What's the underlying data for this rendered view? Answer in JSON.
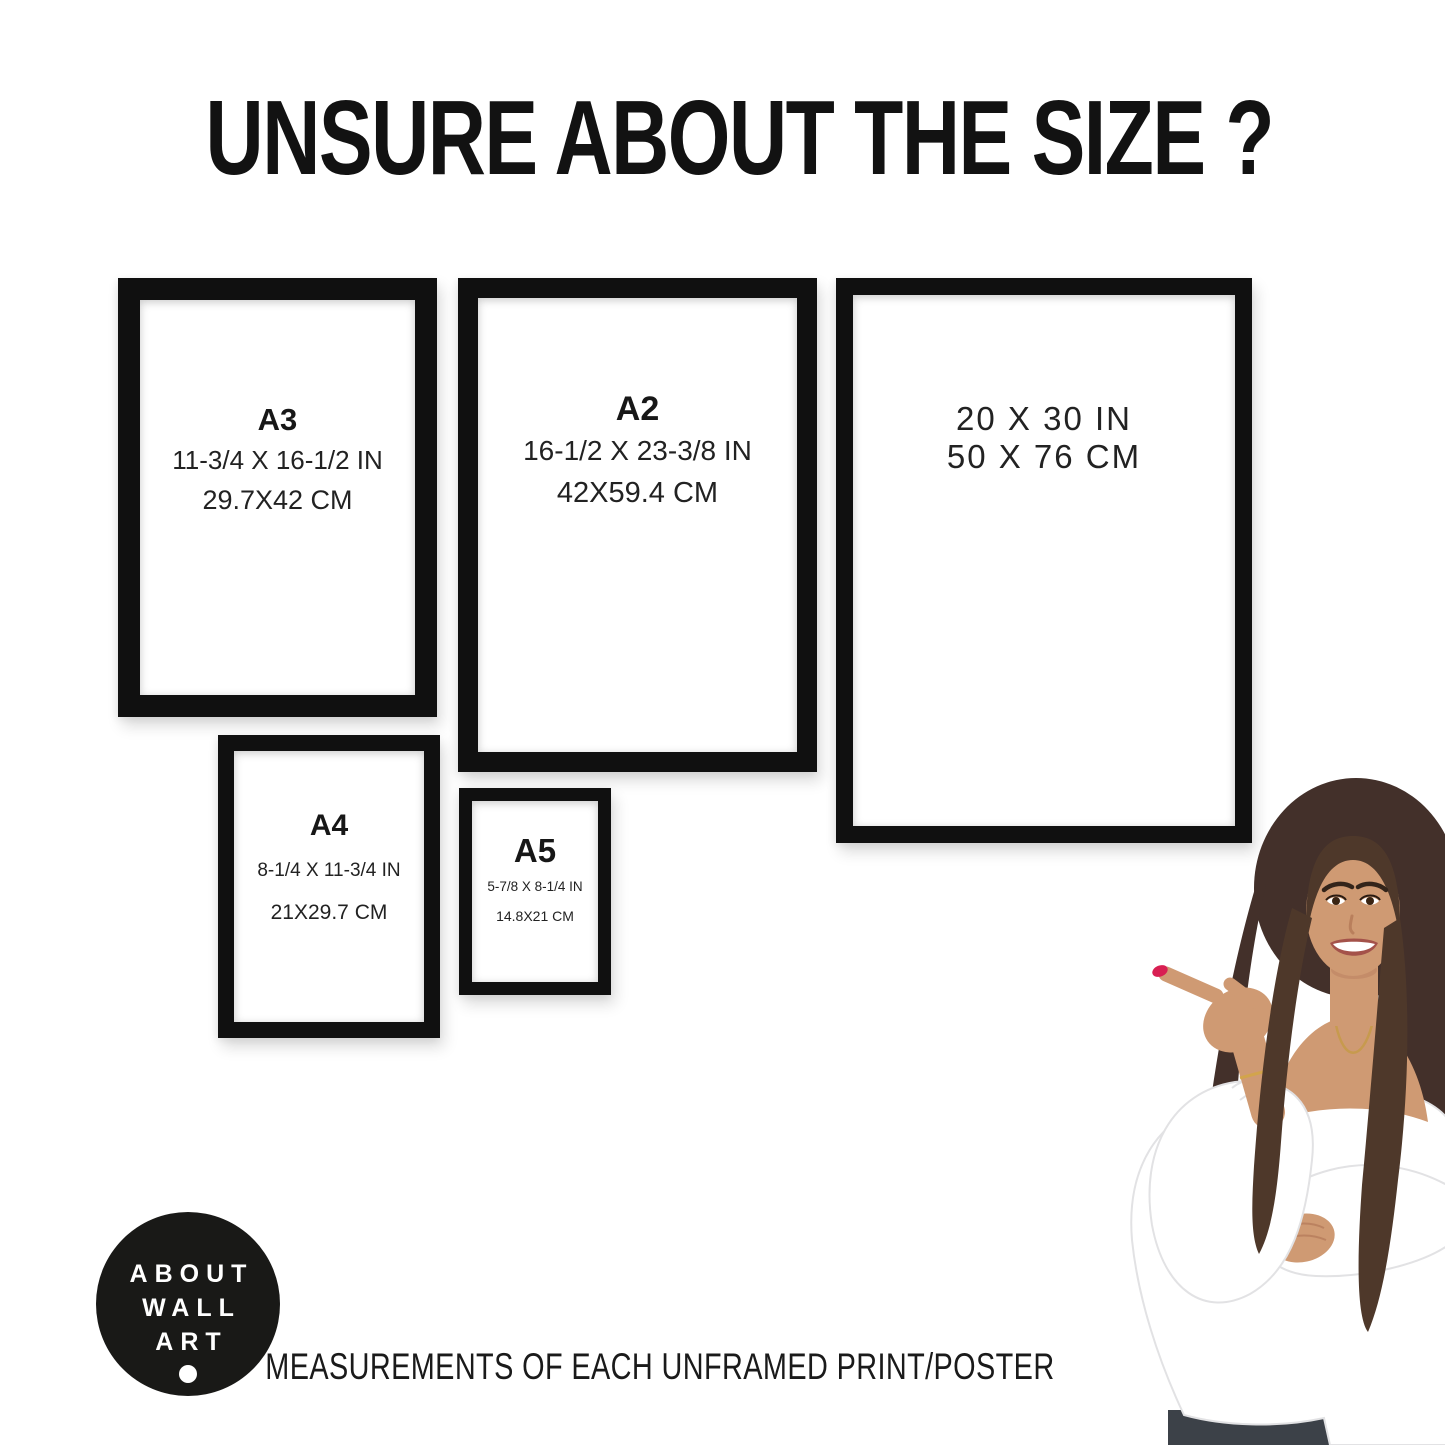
{
  "title": "UNSURE ABOUT THE SIZE ?",
  "frames": [
    {
      "name": "A3",
      "inches": "11-3/4 X 16-1/2 IN",
      "cm": "29.7X42 CM"
    },
    {
      "name": "A2",
      "inches": "16-1/2 X 23-3/8 IN",
      "cm": "42X59.4 CM"
    },
    {
      "name": "",
      "inches": "20 X 30 IN",
      "cm": "50 X 76 CM"
    },
    {
      "name": "A4",
      "inches": "8-1/4 X 11-3/4 IN",
      "cm": "21X29.7 CM"
    },
    {
      "name": "A5",
      "inches": "5-7/8 X 8-1/4 IN",
      "cm": "14.8X21 CM"
    }
  ],
  "logo": {
    "lines": [
      "ABOUT",
      "WALL",
      "ART"
    ]
  },
  "footer": "MEASUREMENTS OF EACH UNFRAMED PRINT/POSTER",
  "colors": {
    "background": "#ffffff",
    "frame": "#101010",
    "text": "#1d1d1b",
    "logo_bg": "#191917",
    "logo_text": "#ffffff",
    "nail_red": "#d81f52",
    "hair_brown": "#4e382a",
    "skin_tan": "#cf9a73",
    "blouse_white": "#ffffff"
  }
}
